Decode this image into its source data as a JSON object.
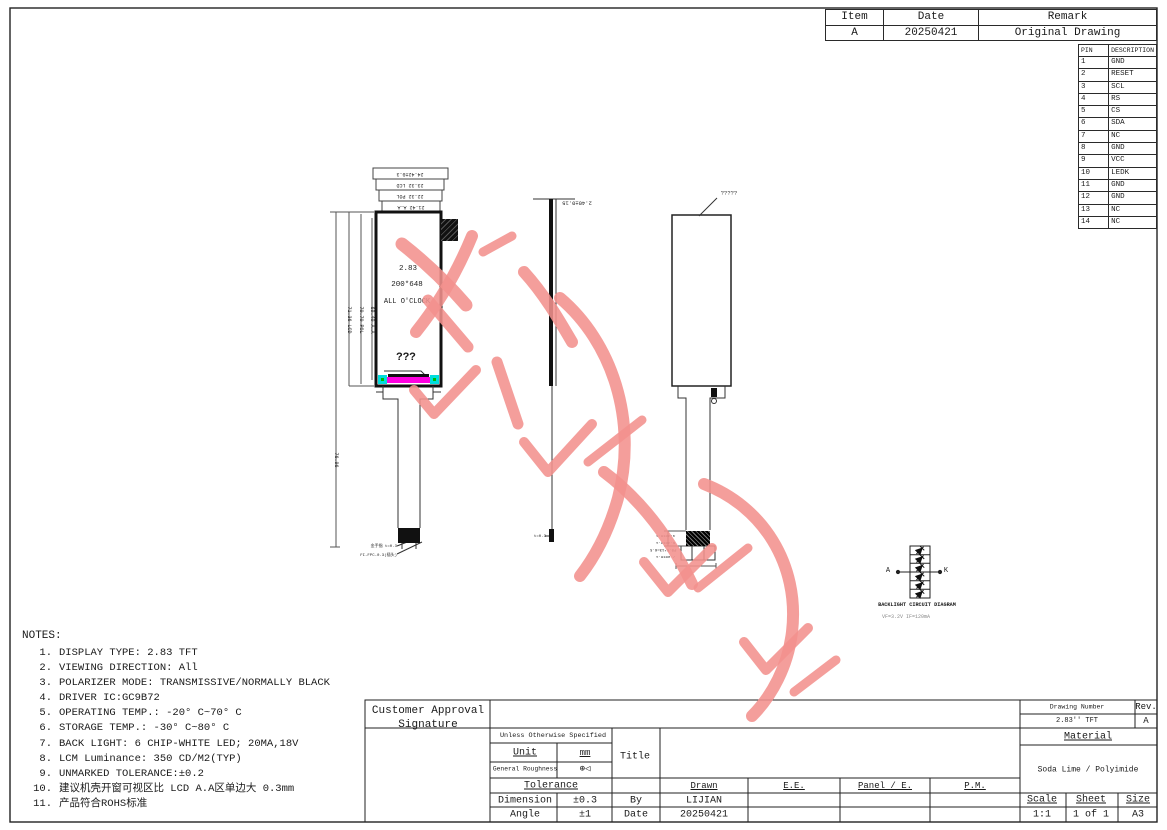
{
  "revision_table": {
    "headers": [
      "Item",
      "Date",
      "Remark"
    ],
    "rows": [
      [
        "A",
        "20250421",
        "Original Drawing"
      ]
    ]
  },
  "pin_table": {
    "headers": [
      "PIN",
      "DESCRIPTION"
    ],
    "rows": [
      [
        "1",
        "GND"
      ],
      [
        "2",
        "RESET"
      ],
      [
        "3",
        "SCL"
      ],
      [
        "4",
        "RS"
      ],
      [
        "5",
        "CS"
      ],
      [
        "6",
        "SDA"
      ],
      [
        "7",
        "NC"
      ],
      [
        "8",
        "GND"
      ],
      [
        "9",
        "VCC"
      ],
      [
        "10",
        "LEDK"
      ],
      [
        "11",
        "GND"
      ],
      [
        "12",
        "GND"
      ],
      [
        "13",
        "NC"
      ],
      [
        "14",
        "NC"
      ]
    ]
  },
  "front_view": {
    "label_size": "2.83",
    "label_resolution": "200*648",
    "label_clock": "ALL O'CLOCK",
    "label_unknown": "???",
    "dims_top": [
      "24.42±0.3",
      "23.32 LCD",
      "22.32 POL",
      "21.42 A.A"
    ],
    "dims_left": [
      "76.96",
      "71.36 LCD",
      "70.70 POL",
      "69.40 A.A"
    ],
    "fpc_labels": [
      "金手指 t=0.3",
      "FI-FPC-0.3(插头)"
    ]
  },
  "side_view": {
    "dim_thickness": "2.40±0.15",
    "dim_bottom": "t=0.3"
  },
  "back_view": {
    "top_label": "?????",
    "dim_labels": [
      "4.30±0.1",
      "6.30±0.1",
      "P0.5*13=6.5",
      "7.90±0.1"
    ]
  },
  "backlight": {
    "caption": "BACKLIGHT CIRCUIT DIAGRAM",
    "spec": "VF=3.2V  IF=120mA",
    "anode": "A",
    "cathode": "K"
  },
  "notes": {
    "title": "NOTES:",
    "items": [
      {
        "num": "1.",
        "text": "DISPLAY TYPE:   2.83 TFT"
      },
      {
        "num": "2.",
        "text": "VIEWING DIRECTION: All"
      },
      {
        "num": "3.",
        "text": "POLARIZER MODE:  TRANSMISSIVE/NORMALLY BLACK"
      },
      {
        "num": "4.",
        "text": "DRIVER IC:GC9B72"
      },
      {
        "num": "5.",
        "text": "OPERATING TEMP.:   -20° C~70° C"
      },
      {
        "num": "6.",
        "text": "STORAGE TEMP.:   -30° C~80° C"
      },
      {
        "num": "7.",
        "text": "BACK LIGHT: 6 CHIP-WHITE LED; 20MA,18V"
      },
      {
        "num": "8.",
        "text": "LCM Luminance: 350 CD/M2(TYP)"
      },
      {
        "num": "9.",
        "text": "UNMARKED TOLERANCE:±0.2"
      },
      {
        "num": "10.",
        "text": "建议机壳开窗可视区比 LCD A.A区单边大 0.3mm"
      },
      {
        "num": "11.",
        "text": "产品符合ROHS标准"
      }
    ]
  },
  "title_block": {
    "customer_approval": "Customer Approval",
    "signature": "Signature",
    "unless": "Unless Otherwise Specified",
    "unit_label": "Unit",
    "unit_value": "mm",
    "roughness_label": "General Roughness",
    "roughness_glyph": "⊕◁",
    "title_label": "Title",
    "tolerance_label": "Tolerance",
    "dimension_label": "Dimension",
    "dimension_value": "±0.3",
    "angle_label": "Angle",
    "angle_value": "±1",
    "by_label": "By",
    "by_value": "LIJIAN",
    "date_label": "Date",
    "date_value": "20250421",
    "drawn_label": "Drawn",
    "ee_label": "E.E.",
    "panel_label": "Panel / E.",
    "pm_label": "P.M.",
    "drawing_number_label": "Drawing Number",
    "drawing_number": "2.83'' TFT",
    "rev_label": "Rev.",
    "rev_value": "A",
    "material_label": "Material",
    "material_value": "Soda Lime / Polyimide",
    "scale_label": "Scale",
    "scale_value": "1:1",
    "sheet_label": "Sheet",
    "sheet_value": "1 of 1",
    "size_label": "Size",
    "size_value": "A3"
  },
  "colors": {
    "watermark_pink": "#f2918d",
    "bonding_magenta": "#ff00e0",
    "bonding_cyan": "#00dddd",
    "bonding_green": "#00bb00"
  }
}
